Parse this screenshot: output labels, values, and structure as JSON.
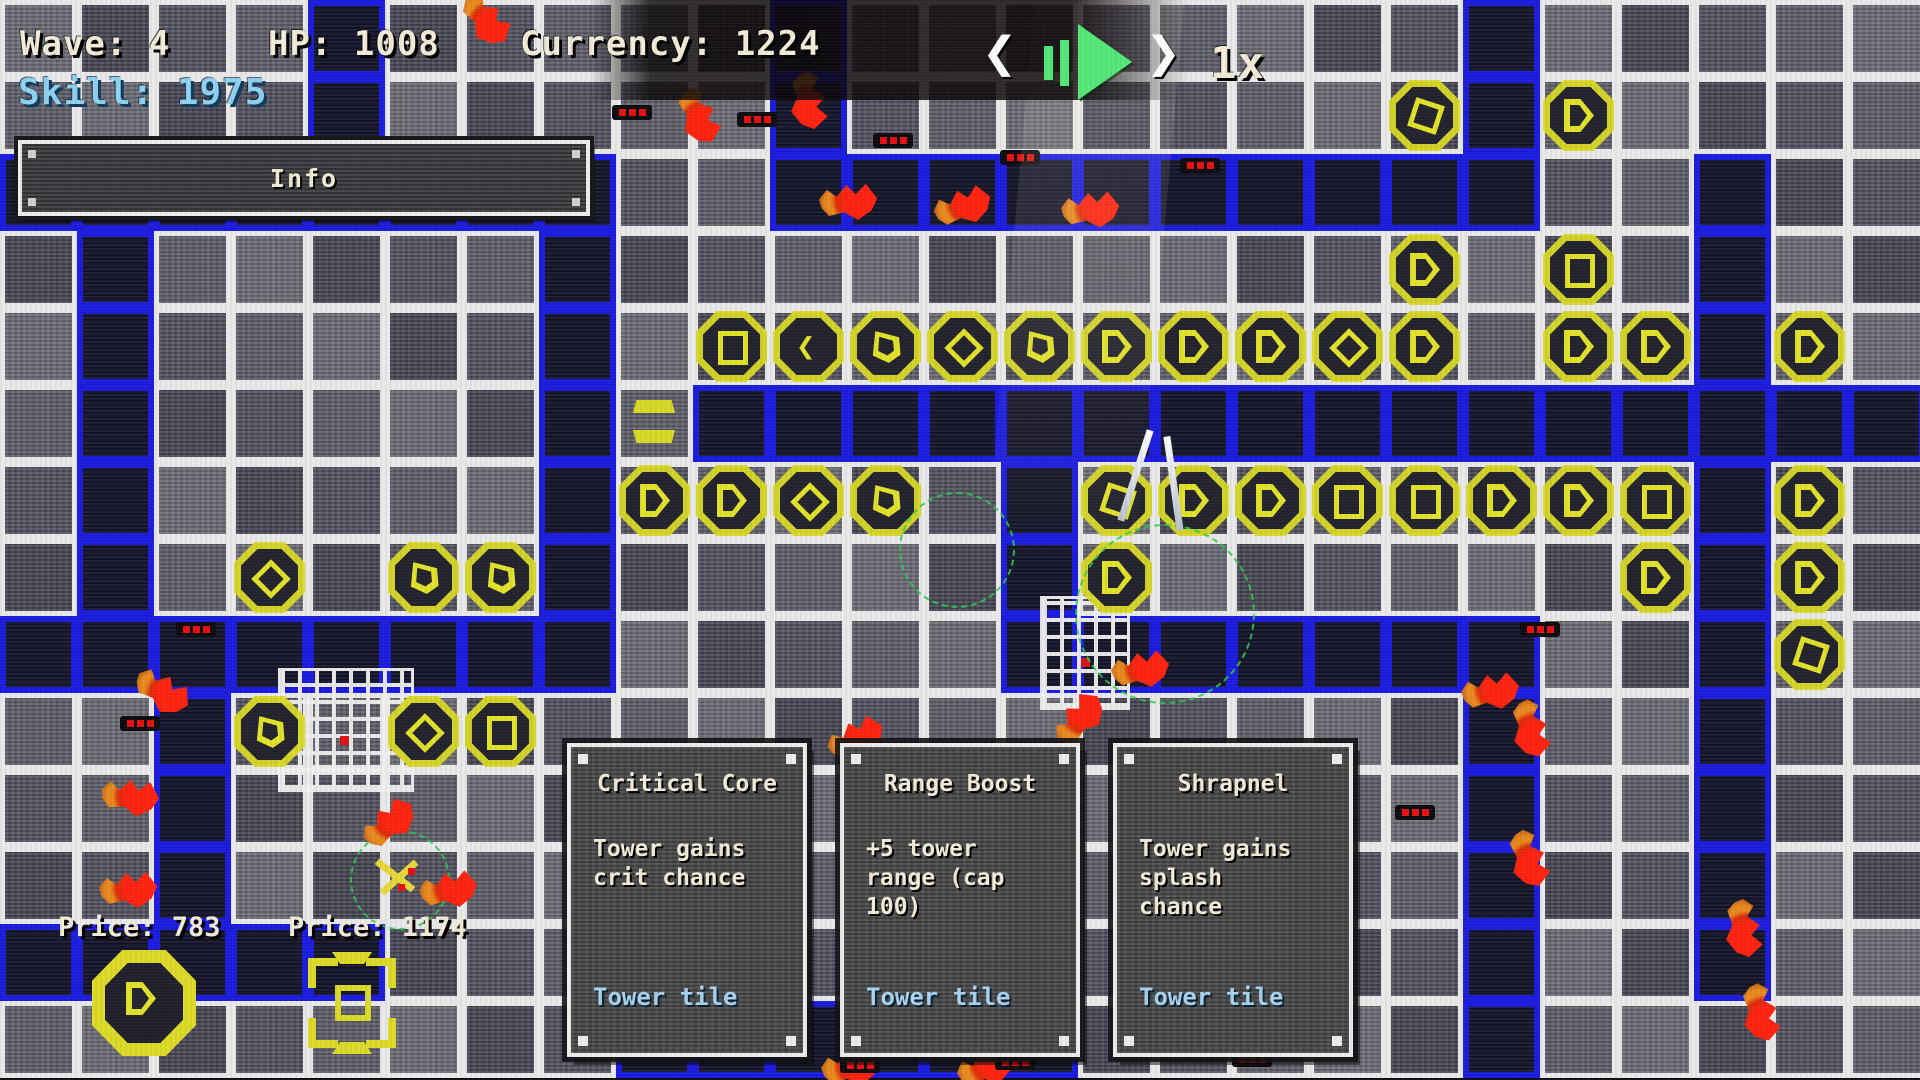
{
  "hud": {
    "wave_label": "Wave: 4",
    "hp_label": "HP: 1008",
    "currency_label": "Currency: 1224",
    "skill_label": "Skill: 1975",
    "info_label": "Info",
    "speed_label": "1x",
    "icons": [
      "prev-wave-chevron",
      "pause-icon",
      "play-icon",
      "next-wave-chevron"
    ],
    "accent_green": "#55e878",
    "skill_color": "#8fd2f2"
  },
  "cards": [
    {
      "title": "Critical Core",
      "body": "Tower gains\ncrit chance",
      "footer": "Tower tile"
    },
    {
      "title": "Range Boost",
      "body": "+5 tower\nrange (cap\n100)",
      "footer": "Tower tile"
    },
    {
      "title": "Shrapnel",
      "body": "Tower gains\nsplash\nchance",
      "footer": "Tower tile"
    }
  ],
  "shop": {
    "items": [
      {
        "price_label": "Price: 783",
        "icon": "octagon-play-tower-icon"
      },
      {
        "price_label": "Price: 1174",
        "icon": "bracket-tower-icon"
      }
    ]
  },
  "colors": {
    "path_border": "#1c1cdf",
    "grid_line": "#e9e9e9",
    "tower_yellow": "#d9d926",
    "enemy_red": "#ff2310",
    "card_footer_blue": "#a9d3ef"
  },
  "grid": {
    "cols": 25,
    "rows": 14,
    "tile": 77,
    "path_tiles": [
      [
        4,
        0
      ],
      [
        4,
        1
      ],
      [
        4,
        2
      ],
      [
        0,
        2
      ],
      [
        1,
        2
      ],
      [
        2,
        2
      ],
      [
        3,
        2
      ],
      [
        5,
        2
      ],
      [
        6,
        2
      ],
      [
        7,
        2
      ],
      [
        7,
        3
      ],
      [
        7,
        4
      ],
      [
        7,
        5
      ],
      [
        7,
        6
      ],
      [
        7,
        7
      ],
      [
        7,
        8
      ],
      [
        1,
        3
      ],
      [
        1,
        4
      ],
      [
        1,
        5
      ],
      [
        1,
        6
      ],
      [
        1,
        7
      ],
      [
        1,
        8
      ],
      [
        0,
        8
      ],
      [
        2,
        8
      ],
      [
        3,
        8
      ],
      [
        4,
        8
      ],
      [
        5,
        8
      ],
      [
        6,
        8
      ],
      [
        2,
        9
      ],
      [
        2,
        10
      ],
      [
        2,
        11
      ],
      [
        2,
        12
      ],
      [
        0,
        12
      ],
      [
        1,
        12
      ],
      [
        3,
        12
      ],
      [
        4,
        12
      ],
      [
        10,
        0
      ],
      [
        10,
        1
      ],
      [
        10,
        2
      ],
      [
        11,
        2
      ],
      [
        12,
        2
      ],
      [
        13,
        2
      ],
      [
        14,
        2
      ],
      [
        15,
        2
      ],
      [
        16,
        2
      ],
      [
        17,
        2
      ],
      [
        18,
        2
      ],
      [
        19,
        0
      ],
      [
        19,
        1
      ],
      [
        19,
        2
      ],
      [
        22,
        2
      ],
      [
        22,
        3
      ],
      [
        22,
        4
      ],
      [
        9,
        5
      ],
      [
        10,
        5
      ],
      [
        11,
        5
      ],
      [
        12,
        5
      ],
      [
        13,
        5
      ],
      [
        14,
        5
      ],
      [
        15,
        5
      ],
      [
        16,
        5
      ],
      [
        17,
        5
      ],
      [
        18,
        5
      ],
      [
        19,
        5
      ],
      [
        20,
        5
      ],
      [
        21,
        5
      ],
      [
        22,
        5
      ],
      [
        23,
        5
      ],
      [
        24,
        5
      ],
      [
        13,
        6
      ],
      [
        13,
        7
      ],
      [
        13,
        8
      ],
      [
        14,
        8
      ],
      [
        15,
        8
      ],
      [
        16,
        8
      ],
      [
        17,
        8
      ],
      [
        18,
        8
      ],
      [
        19,
        8
      ],
      [
        19,
        9
      ],
      [
        19,
        10
      ],
      [
        19,
        11
      ],
      [
        19,
        12
      ],
      [
        19,
        13
      ],
      [
        22,
        6
      ],
      [
        22,
        7
      ],
      [
        22,
        8
      ],
      [
        22,
        9
      ],
      [
        22,
        10
      ],
      [
        22,
        11
      ],
      [
        22,
        12
      ],
      [
        8,
        13
      ],
      [
        9,
        13
      ],
      [
        10,
        13
      ],
      [
        11,
        13
      ],
      [
        12,
        13
      ],
      [
        13,
        13
      ]
    ]
  },
  "towers": [
    {
      "col": 9,
      "row": 4,
      "variant": "square"
    },
    {
      "col": 10,
      "row": 4,
      "variant": "chevron"
    },
    {
      "col": 11,
      "row": 4,
      "variant": "spade"
    },
    {
      "col": 12,
      "row": 4,
      "variant": "diamond"
    },
    {
      "col": 13,
      "row": 4,
      "variant": "spade"
    },
    {
      "col": 14,
      "row": 4,
      "variant": "play"
    },
    {
      "col": 15,
      "row": 4,
      "variant": "play"
    },
    {
      "col": 16,
      "row": 4,
      "variant": "play"
    },
    {
      "col": 17,
      "row": 4,
      "variant": "diamond"
    },
    {
      "col": 18,
      "row": 4,
      "variant": "play"
    },
    {
      "col": 20,
      "row": 4,
      "variant": "play"
    },
    {
      "col": 21,
      "row": 4,
      "variant": "play"
    },
    {
      "col": 23,
      "row": 4,
      "variant": "play"
    },
    {
      "col": 18,
      "row": 1,
      "variant": "tilted"
    },
    {
      "col": 20,
      "row": 1,
      "variant": "play"
    },
    {
      "col": 18,
      "row": 3,
      "variant": "play"
    },
    {
      "col": 20,
      "row": 3,
      "variant": "square"
    },
    {
      "col": 8,
      "row": 5,
      "variant": "link"
    },
    {
      "col": 8,
      "row": 6,
      "variant": "play"
    },
    {
      "col": 9,
      "row": 6,
      "variant": "play"
    },
    {
      "col": 10,
      "row": 6,
      "variant": "diamond"
    },
    {
      "col": 11,
      "row": 6,
      "variant": "spade"
    },
    {
      "col": 14,
      "row": 6,
      "variant": "tilted"
    },
    {
      "col": 15,
      "row": 6,
      "variant": "play"
    },
    {
      "col": 16,
      "row": 6,
      "variant": "play"
    },
    {
      "col": 17,
      "row": 6,
      "variant": "square"
    },
    {
      "col": 18,
      "row": 6,
      "variant": "square"
    },
    {
      "col": 19,
      "row": 6,
      "variant": "play"
    },
    {
      "col": 20,
      "row": 6,
      "variant": "play"
    },
    {
      "col": 21,
      "row": 6,
      "variant": "square"
    },
    {
      "col": 23,
      "row": 6,
      "variant": "play"
    },
    {
      "col": 14,
      "row": 7,
      "variant": "play"
    },
    {
      "col": 21,
      "row": 7,
      "variant": "play"
    },
    {
      "col": 23,
      "row": 7,
      "variant": "play"
    },
    {
      "col": 23,
      "row": 8,
      "variant": "tilted"
    },
    {
      "col": 3,
      "row": 7,
      "variant": "diamond"
    },
    {
      "col": 5,
      "row": 7,
      "variant": "spade"
    },
    {
      "col": 6,
      "row": 7,
      "variant": "spade"
    },
    {
      "col": 3,
      "row": 9,
      "variant": "spade"
    },
    {
      "col": 5,
      "row": 9,
      "variant": "diamond"
    },
    {
      "col": 6,
      "row": 9,
      "variant": "square"
    }
  ],
  "enemies": [
    {
      "x": 810,
      "y": 100,
      "rot": 90
    },
    {
      "x": 848,
      "y": 200,
      "rot": 5
    },
    {
      "x": 962,
      "y": 205,
      "rot": -8
    },
    {
      "x": 1090,
      "y": 208,
      "rot": 4
    },
    {
      "x": 700,
      "y": 115,
      "rot": 75
    },
    {
      "x": 487,
      "y": 18,
      "rot": 60
    },
    {
      "x": 163,
      "y": 690,
      "rot": 40
    },
    {
      "x": 130,
      "y": 795,
      "rot": 15
    },
    {
      "x": 128,
      "y": 888,
      "rot": 5
    },
    {
      "x": 388,
      "y": 822,
      "rot": -30
    },
    {
      "x": 448,
      "y": 888,
      "rot": 0
    },
    {
      "x": 855,
      "y": 737,
      "rot": -15
    },
    {
      "x": 1140,
      "y": 668,
      "rot": 0
    },
    {
      "x": 1078,
      "y": 718,
      "rot": -40
    },
    {
      "x": 1490,
      "y": 690,
      "rot": 0
    },
    {
      "x": 1532,
      "y": 728,
      "rot": 85
    },
    {
      "x": 1530,
      "y": 858,
      "rot": 80
    },
    {
      "x": 1745,
      "y": 928,
      "rot": 90
    },
    {
      "x": 1762,
      "y": 1012,
      "rot": 85
    },
    {
      "x": 850,
      "y": 1066,
      "rot": 0
    },
    {
      "x": 985,
      "y": 1066,
      "rot": -10
    }
  ],
  "health_bars": [
    {
      "x": 612,
      "y": 105
    },
    {
      "x": 737,
      "y": 112
    },
    {
      "x": 873,
      "y": 133
    },
    {
      "x": 1000,
      "y": 150
    },
    {
      "x": 1180,
      "y": 158
    },
    {
      "x": 176,
      "y": 622
    },
    {
      "x": 120,
      "y": 716
    },
    {
      "x": 930,
      "y": 852
    },
    {
      "x": 1395,
      "y": 805
    },
    {
      "x": 1520,
      "y": 622
    },
    {
      "x": 617,
      "y": 1043
    },
    {
      "x": 840,
      "y": 1058
    },
    {
      "x": 995,
      "y": 1055
    },
    {
      "x": 1232,
      "y": 1052
    }
  ],
  "structures": {
    "wireframes": [
      {
        "x": 278,
        "y": 668,
        "w": 130,
        "h": 118
      },
      {
        "x": 1040,
        "y": 596,
        "w": 84,
        "h": 108
      }
    ],
    "range_circles": [
      {
        "cx": 1163,
        "cy": 612,
        "r": 88
      },
      {
        "cx": 398,
        "cy": 878,
        "r": 48
      },
      {
        "cx": 955,
        "cy": 548,
        "r": 56
      }
    ]
  }
}
